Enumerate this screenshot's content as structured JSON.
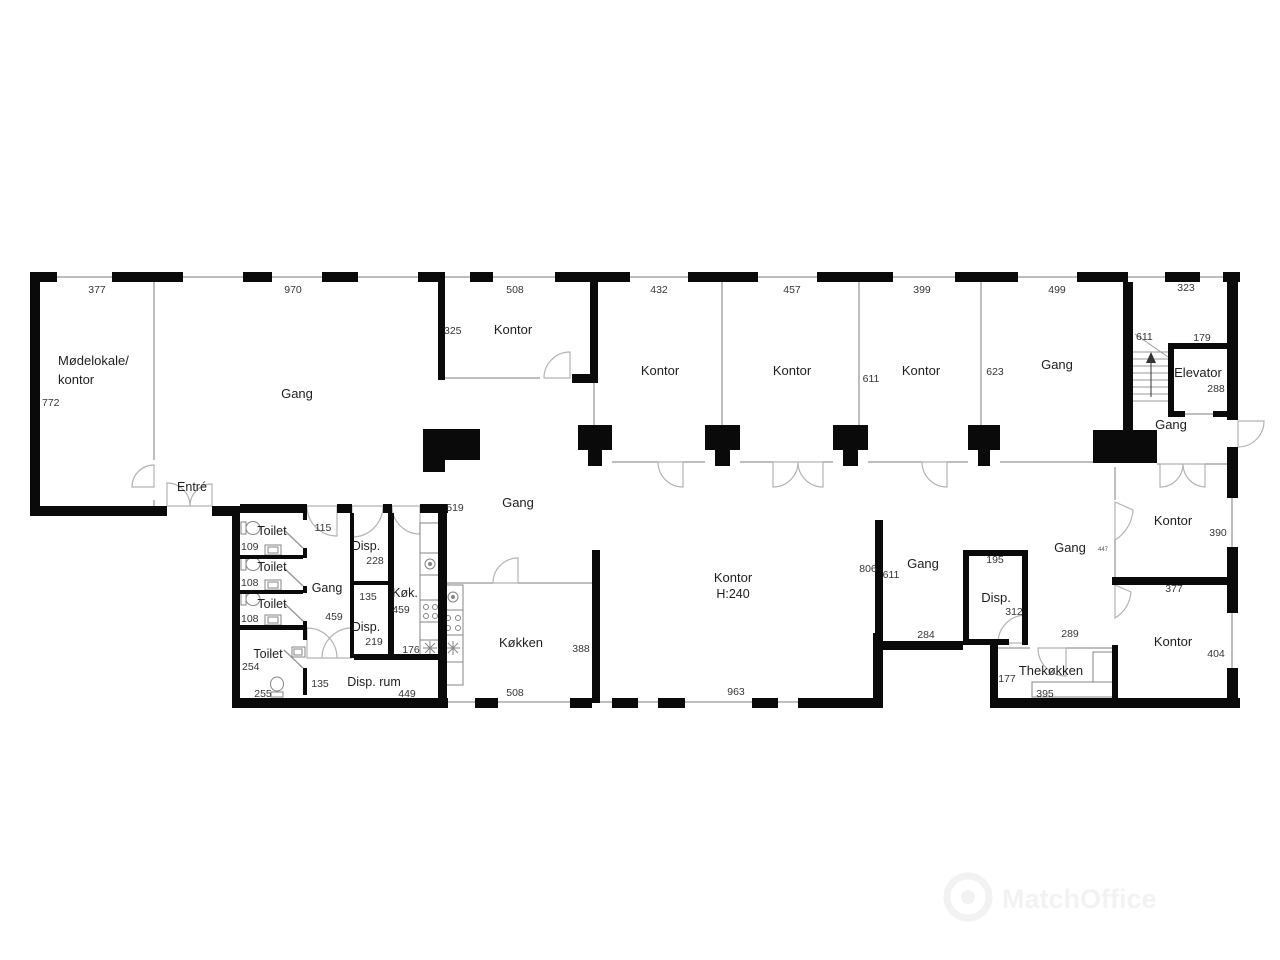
{
  "plan": {
    "top_dims": [
      "377",
      "970",
      "508",
      "432",
      "457",
      "399",
      "499",
      "323"
    ],
    "rooms": {
      "meeting": {
        "name1": "Mødelokale/",
        "name2": "kontor",
        "width": "772"
      },
      "hall": {
        "name": "Gang",
        "entrance": "Entré"
      },
      "office_small": {
        "name": "Kontor",
        "depth": "325"
      },
      "office1": {
        "name": "Kontor"
      },
      "office2": {
        "name": "Kontor",
        "sep": "611"
      },
      "office3": {
        "name": "Kontor",
        "sep": "623"
      },
      "gang_ne": {
        "name": "Gang"
      },
      "stairwell": {
        "width": "611"
      },
      "elevator": {
        "name": "Elevator",
        "width": "179",
        "depth": "288"
      },
      "gang_elevator": {
        "name": "Gang"
      },
      "corridor": {
        "name": "Gang",
        "width": "519"
      },
      "wc_gang": {
        "name": "Gang",
        "width": "115",
        "depth": "459"
      },
      "wc1": {
        "name": "Toilet",
        "num": "109"
      },
      "wc2": {
        "name": "Toilet",
        "num": "108"
      },
      "wc3": {
        "name": "Toilet",
        "num": "108"
      },
      "wc4": {
        "name": "Toilet",
        "num": "254",
        "num2": "255"
      },
      "disp1": {
        "name": "Disp.",
        "depth": "228",
        "width": "135"
      },
      "disp2": {
        "name": "Disp.",
        "depth": "219"
      },
      "kok": {
        "name": "Køk.",
        "depth": "459",
        "width": "176"
      },
      "disp_rum": {
        "name": "Disp. rum",
        "width": "135",
        "depth": "449"
      },
      "kitchen": {
        "name": "Køkken",
        "width": "508",
        "sep": "388"
      },
      "open_office": {
        "name": "Kontor",
        "height": "H:240",
        "width": "963",
        "sep_left": "806",
        "sep_right": "611"
      },
      "gang_mid": {
        "name": "Gang",
        "width": "284"
      },
      "disp3": {
        "name": "Disp.",
        "width": "195",
        "depth": "312"
      },
      "gang_east": {
        "name": "Gang",
        "door": "447"
      },
      "tea_kitchen": {
        "name": "Thekøkken",
        "height": "177",
        "width_top": "289",
        "width": "395"
      },
      "office_e1": {
        "name": "Kontor",
        "depth": "390",
        "width": "377"
      },
      "office_e2": {
        "name": "Kontor",
        "depth": "404"
      }
    },
    "watermark": "MatchOffice"
  }
}
